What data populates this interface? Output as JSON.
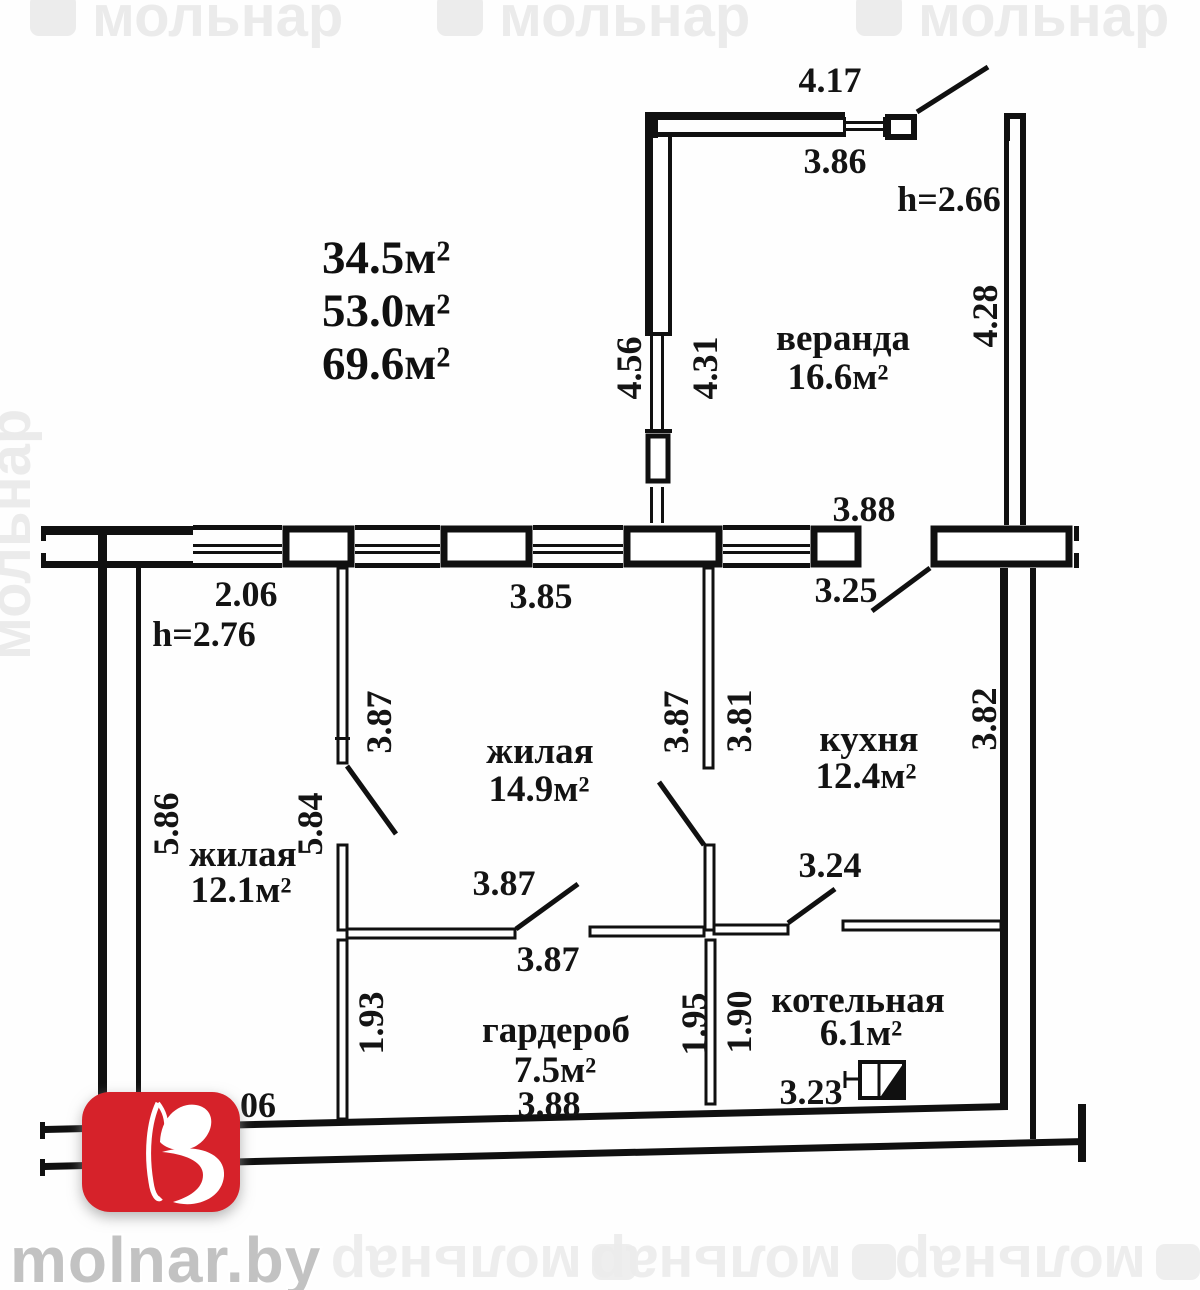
{
  "summary": {
    "areas": [
      "34.5м²",
      "53.0м²",
      "69.6м²"
    ]
  },
  "rooms": {
    "veranda": {
      "name": "веранда",
      "area": "16.6м²"
    },
    "living_main": {
      "name": "жилая",
      "area": "14.9м²"
    },
    "living_second": {
      "name": "жилая",
      "area": "12.1м²"
    },
    "kitchen": {
      "name": "кухня",
      "area": "12.4м²"
    },
    "wardrobe": {
      "name": "гардероб",
      "area": "7.5м²"
    },
    "boiler": {
      "name": "котельная",
      "area": "6.1м²"
    }
  },
  "heights": {
    "veranda": "h=2.66",
    "main": "h=2.76"
  },
  "dimensions": {
    "veranda_top_outer": "4.17",
    "veranda_top_inner": "3.86",
    "veranda_left_outer": "4.56",
    "veranda_left_inner": "4.31",
    "veranda_right": "4.28",
    "kitchen_top_width": "3.88",
    "kitchen_entry_width": "3.25",
    "stub_width": "2.06",
    "living_main_width": "3.85",
    "living_main_depth": "3.87",
    "kitchen_west_depth": "3.87",
    "kitchen_depth": "3.81",
    "kitchen_east_depth": "3.82",
    "living_second_depth_left": "5.86",
    "living_second_depth_right": "5.84",
    "wardrobe_door_width": "3.87",
    "wardrobe_top_width": "3.87",
    "boiler_door_width": "3.24",
    "wardrobe_height_left": "1.93",
    "wardrobe_height_right": "1.95",
    "boiler_height_left": "1.90",
    "wardrobe_bottom_width": "3.88",
    "boiler_bottom_width": "3.23",
    "partial_bottom_left": "06"
  },
  "branding": {
    "site": "molnar.by",
    "watermark": "мольнар"
  },
  "colors": {
    "logo_red": "#d6232b",
    "ink": "#101010"
  }
}
